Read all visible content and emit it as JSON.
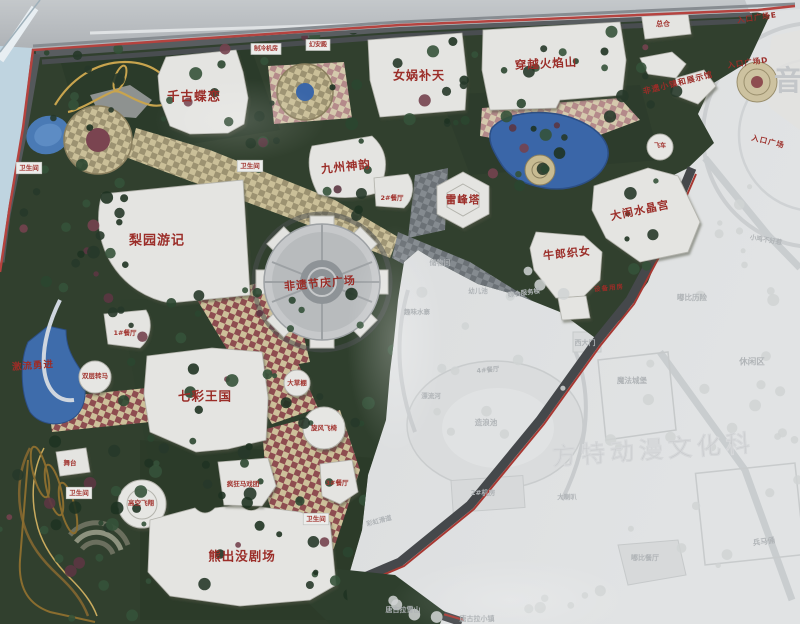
{
  "colors": {
    "label_red": "#9b2d28",
    "border_red": "#b5433f",
    "board_bg": "#dcdee0",
    "band_grey": "#b7babe",
    "sky_blue": "#bfd4e0",
    "foliage_green": "#31402e",
    "water_blue": "#3e6cab",
    "checker_tan": "#cabf98",
    "checker_maroon": "#8e4d50",
    "faded_text": "#b0b4b7"
  },
  "map": {
    "attraction_labels": [
      {
        "text": "千古蝶恋",
        "x": 194,
        "y": 97,
        "size": 12.5,
        "rot": 0
      },
      {
        "text": "女娲补天",
        "x": 419,
        "y": 76,
        "size": 12,
        "rot": 0
      },
      {
        "text": "穿越火焰山",
        "x": 546,
        "y": 64,
        "size": 11.5,
        "rot": -3
      },
      {
        "text": "九州神韵",
        "x": 346,
        "y": 167,
        "size": 11.5,
        "rot": -6
      },
      {
        "text": "梨园游记",
        "x": 157,
        "y": 241,
        "size": 13,
        "rot": 0
      },
      {
        "text": "雷峰塔",
        "x": 463,
        "y": 200,
        "size": 10.5,
        "rot": 0
      },
      {
        "text": "牛郎织女",
        "x": 567,
        "y": 254,
        "size": 11,
        "rot": -6
      },
      {
        "text": "大闹水晶宫",
        "x": 640,
        "y": 211,
        "size": 11,
        "rot": -12
      },
      {
        "text": "非遗节庆广场",
        "x": 320,
        "y": 284,
        "size": 11,
        "rot": -5
      },
      {
        "text": "七彩王国",
        "x": 205,
        "y": 397,
        "size": 12.5,
        "rot": 0
      },
      {
        "text": "熊出没剧场",
        "x": 242,
        "y": 557,
        "size": 12.5,
        "rot": 0
      },
      {
        "text": "激流勇进",
        "x": 33,
        "y": 366,
        "size": 9.5,
        "rot": -4
      },
      {
        "text": "非遗小镇和展示馆",
        "x": 678,
        "y": 83,
        "size": 8,
        "rot": -14
      },
      {
        "text": "入口广场E",
        "x": 757,
        "y": 18,
        "size": 7.5,
        "rot": -8
      },
      {
        "text": "入口广场D",
        "x": 748,
        "y": 63,
        "size": 7.5,
        "rot": -8
      },
      {
        "text": "入口广场",
        "x": 768,
        "y": 142,
        "size": 7.5,
        "rot": 14
      },
      {
        "text": "设备用房",
        "x": 609,
        "y": 288,
        "size": 6.5,
        "rot": -6
      }
    ],
    "facility_labels": [
      {
        "text": "总仓",
        "x": 663,
        "y": 24,
        "size": 7,
        "box": false
      },
      {
        "text": "卫生间",
        "x": 29,
        "y": 168,
        "size": 6.5,
        "box": true
      },
      {
        "text": "卫生间",
        "x": 250,
        "y": 166,
        "size": 6.5,
        "box": true
      },
      {
        "text": "卫生间",
        "x": 79,
        "y": 493,
        "size": 6.5,
        "box": true
      },
      {
        "text": "卫生间",
        "x": 316,
        "y": 519,
        "size": 6.5,
        "box": true
      },
      {
        "text": "1#餐厅",
        "x": 125,
        "y": 333,
        "size": 6.5,
        "box": false
      },
      {
        "text": "2#餐厅",
        "x": 392,
        "y": 198,
        "size": 6.5,
        "box": false
      },
      {
        "text": "3#餐厅",
        "x": 337,
        "y": 483,
        "size": 6.5,
        "box": false
      },
      {
        "text": "舞台",
        "x": 70,
        "y": 463,
        "size": 6.5,
        "box": false
      },
      {
        "text": "双层转马",
        "x": 95,
        "y": 376,
        "size": 6.5,
        "box": false
      },
      {
        "text": "大草棚",
        "x": 297,
        "y": 383,
        "size": 6.5,
        "box": false
      },
      {
        "text": "旋风飞椅",
        "x": 324,
        "y": 428,
        "size": 6.5,
        "box": false
      },
      {
        "text": "高空飞翔",
        "x": 141,
        "y": 503,
        "size": 6.5,
        "box": false
      },
      {
        "text": "疯狂马戏团",
        "x": 243,
        "y": 484,
        "size": 6.5,
        "box": false
      },
      {
        "text": "制冷机房",
        "x": 266,
        "y": 49,
        "size": 6,
        "box": true
      },
      {
        "text": "幻安殿",
        "x": 318,
        "y": 45,
        "size": 6,
        "box": true
      },
      {
        "text": "飞车",
        "x": 660,
        "y": 146,
        "size": 6,
        "box": false
      }
    ],
    "faded_labels": [
      {
        "text": "储物间",
        "x": 440,
        "y": 263,
        "size": 7,
        "rot": 0
      },
      {
        "text": "幼儿池",
        "x": 478,
        "y": 291,
        "size": 6.5,
        "rot": 0
      },
      {
        "text": "综合服务楼",
        "x": 524,
        "y": 293,
        "size": 6.5,
        "rot": -8
      },
      {
        "text": "趣味水寨",
        "x": 417,
        "y": 312,
        "size": 6.5,
        "rot": 0
      },
      {
        "text": "漂流河",
        "x": 431,
        "y": 396,
        "size": 6.5,
        "rot": 0
      },
      {
        "text": "造浪池",
        "x": 486,
        "y": 423,
        "size": 7.5,
        "rot": 0
      },
      {
        "text": "4#餐厅",
        "x": 488,
        "y": 370,
        "size": 6.5,
        "rot": -5
      },
      {
        "text": "西大门",
        "x": 585,
        "y": 343,
        "size": 7,
        "rot": 0
      },
      {
        "text": "魔法城堡",
        "x": 632,
        "y": 381,
        "size": 7.5,
        "rot": 0
      },
      {
        "text": "嘟比历险",
        "x": 692,
        "y": 298,
        "size": 7.5,
        "rot": 0
      },
      {
        "text": "休闲区",
        "x": 752,
        "y": 362,
        "size": 8.5,
        "rot": 0
      },
      {
        "text": "小鸡不好惹",
        "x": 766,
        "y": 240,
        "size": 6.5,
        "rot": 10
      },
      {
        "text": "2#机房",
        "x": 483,
        "y": 493,
        "size": 7,
        "rot": 0
      },
      {
        "text": "大喇叭",
        "x": 567,
        "y": 497,
        "size": 6.5,
        "rot": 0
      },
      {
        "text": "嘟比餐厅",
        "x": 645,
        "y": 558,
        "size": 7,
        "rot": 0
      },
      {
        "text": "唐古拉雪山",
        "x": 403,
        "y": 610,
        "size": 7,
        "rot": 0
      },
      {
        "text": "唐古拉小镇",
        "x": 477,
        "y": 619,
        "size": 7,
        "rot": 0
      },
      {
        "text": "兵马俑",
        "x": 764,
        "y": 542,
        "size": 7.5,
        "rot": -8
      },
      {
        "text": "彩虹滑道",
        "x": 379,
        "y": 521,
        "size": 6.5,
        "rot": -15
      }
    ],
    "watermark": {
      "text": "方特动漫文化科",
      "x": 654,
      "y": 458,
      "size": 24,
      "rot": -4
    },
    "corner_glyph": {
      "text": "音",
      "x": 788,
      "y": 90,
      "size": 28
    }
  }
}
